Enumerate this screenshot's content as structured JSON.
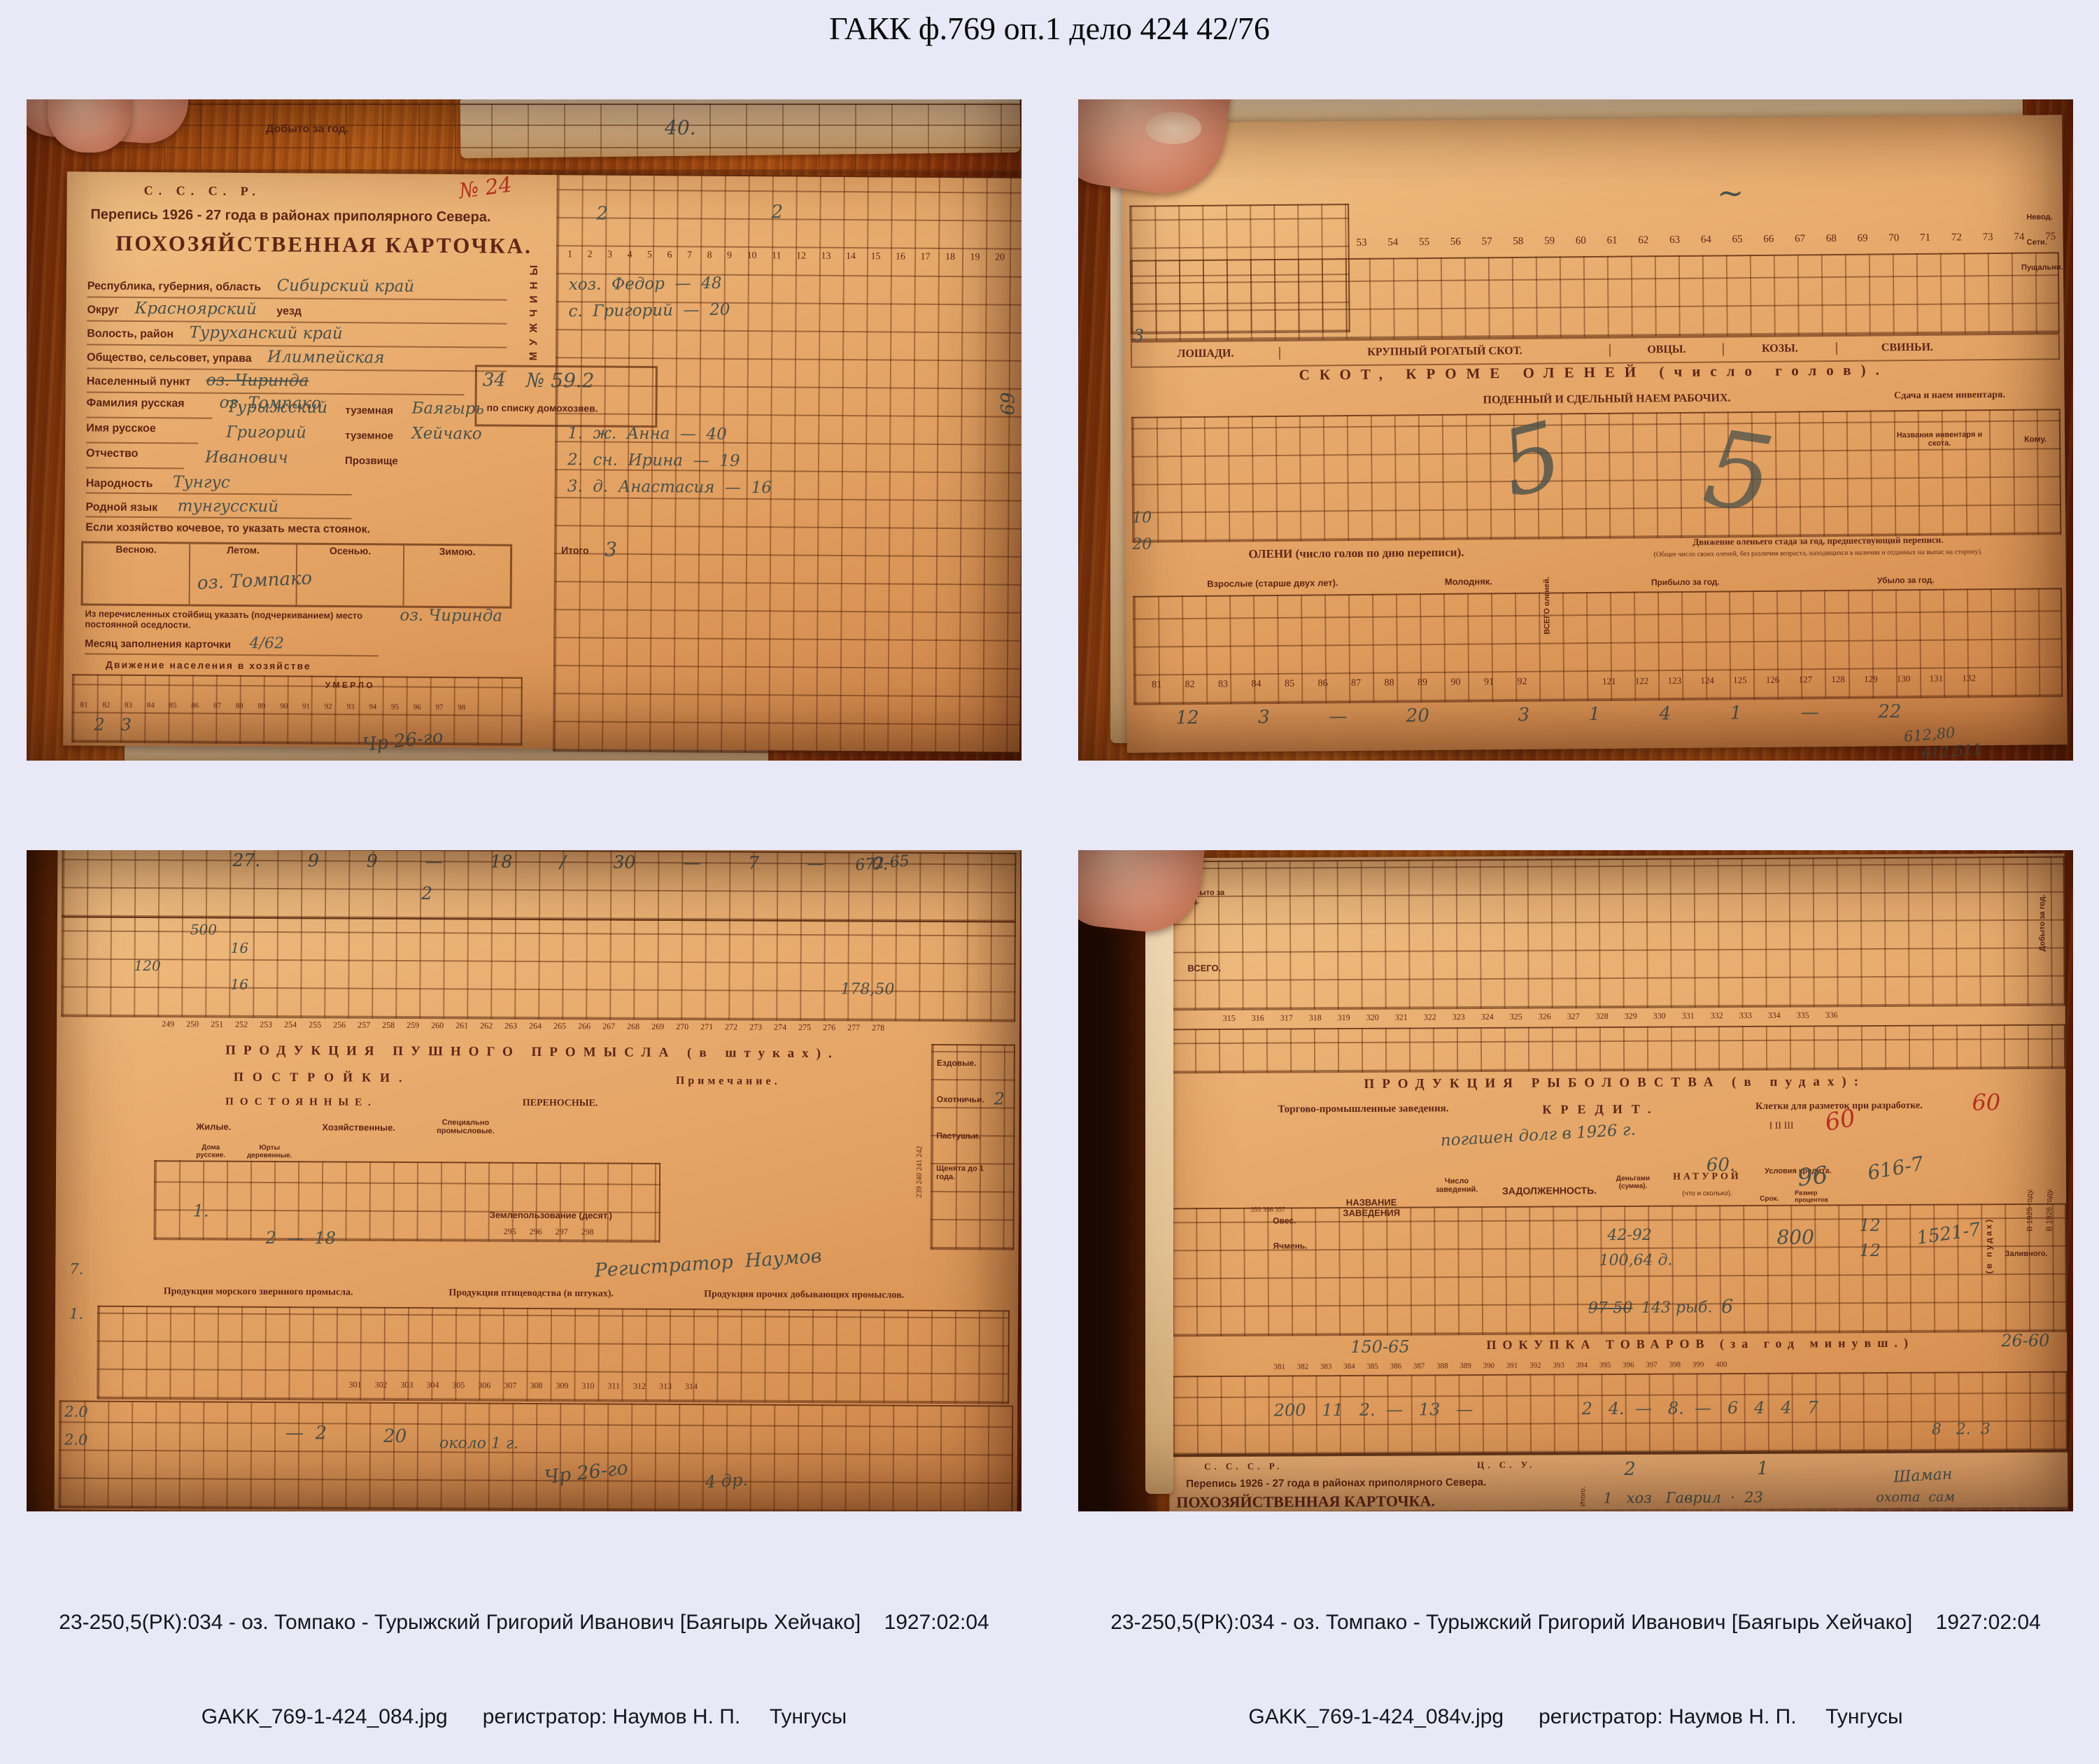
{
  "page": {
    "title": "ГАКК ф.769 оп.1 дело 424 42/76"
  },
  "colors": {
    "background": "#e8e8f6",
    "wood": "#a84e12",
    "paper": "#e3a263",
    "ink": "#5e2614",
    "pencil": "#49514a",
    "red_ink": "#b5311f"
  },
  "photos": [
    {
      "caption1": "23-250,5(РК):034 - оз. Томпако - Турыжский Григорий Иванович [Баягырь Хейчако]    1927:02:04",
      "caption2": "GAKK_769-1-424_083.jpg      регистратор: Наумов Н. П.     Тунгусы",
      "overlay": {
        "top_strip_label": "Добыто за год.",
        "top_strip_hand": "40.",
        "red_note": "№ 24",
        "cccp": "С. С. С. Р.",
        "census": "Перепись 1926 - 27 года в районах приполярного Севера.",
        "card_title": "ПОХОЗЯЙСТВЕННАЯ КАРТОЧКА.",
        "f1_label": "Республика, губерния, область",
        "f1_value": "Сибирский край",
        "f2_label": "Округ",
        "f2_value": "Красноярский",
        "f2_suffix": "уезд",
        "f3_label": "Волость, район",
        "f3_value": "Туруханский край",
        "f4_label": "Общество, сельсовет, управа",
        "f4_value": "Илимпейская",
        "f5_label": "Населенный пункт",
        "f5_value": "оз. Чиринда",
        "f5_value2": "оз. Томпако",
        "box_no": "34",
        "box_no2": "№ 59.2",
        "box_note": "по списку домохозяев.",
        "f6_label": "Фамилия русская",
        "f6_value": "Турыжский",
        "f6_suffix": "туземная",
        "f6_value2": "Баягырь",
        "f7_label": "Имя русское",
        "f7_value": "Григорий",
        "f7_suffix": "туземное",
        "f7_value2": "Хейчако",
        "f8_label": "Отчество",
        "f8_value": "Иванович",
        "f8_suffix": "Прозвище",
        "f9_label": "Народность",
        "f9_value": "Тунгус",
        "f10_label": "Родной язык",
        "f10_value": "тунгусский",
        "nomad_label": "Если хозяйство кочевое, то указать места стоянок.",
        "season1": "Весною.",
        "season2": "Летом.",
        "season3": "Осенью.",
        "season4": "Зимою.",
        "season_value": "оз. Томпако",
        "settle_label": "Из перечисленных стойбищ указать (подчеркиванием) место постоянной оседлости.",
        "settle_value": "оз. Чиринда",
        "fill_label": "Месяц заполнения карточки",
        "fill_value": "4/62",
        "movement_title": "Движение населения в хозяйстве",
        "movement_sub": "У М Е Р Л О",
        "movement_nums": "81 82 83 84 85 86 87 88 89 90 91 92 93 94 95 96 97 98",
        "movement_hand": "2   3",
        "men_vertical": "МУЖЧИНЫ",
        "cols": "1 2 3 4 5 6 7 8 9 10 11 12 13 14 15 16 17 18 19 20",
        "hand_top1": "2",
        "hand_top2": "2",
        "member1": "хоз.  Федор  —  48",
        "member2": "с.  Григорий  —  20",
        "member3": "1.  ж.  Анна  —  40",
        "member4": "2.  сн.  Ирина  —  19",
        "member5": "3.  д.  Анастасия  —  16",
        "itogo_label": "Итого",
        "itogo_hand": "3",
        "scribble1": "Чр 26-го",
        "scribble2": "69"
      }
    },
    {
      "caption1": "23-250,5(РК):034 - оз. Томпако - Турыжский Григорий Иванович [Баягырь Хейчако]    1927:02:04",
      "caption2": "GAKK_769-1-424_083v.jpg      регистратор: Наумов Н. П.     Тунгусы",
      "overlay": {
        "cols_top": "53 54 55 56 57 58 59 60 61 62 63 64 65 66 67 68 69 70 71 72 73 74 75 76",
        "band_horses": "ЛОШАДИ.",
        "band_cattle": "КРУПНЫЙ РОГАТЫЙ СКОТ.",
        "band_sheep": "ОВЦЫ.",
        "band_goats": "КОЗЫ.",
        "band_pigs": "СВИНЬИ.",
        "band_livestock": "СКОТ,  КРОМЕ  ОЛЕНЕЙ  (число голов).",
        "band_hire": "ПОДЕННЫЙ И СДЕЛЬНЫЙ НАЕМ РАБОЧИХ.",
        "band_rent": "Сдача и наем инвентаря.",
        "inv_label": "Названия инвентаря и скота.",
        "komu_label": "Кому.",
        "band_deer": "ОЛЕНИ  (число голов по дню переписи).",
        "deer_adult": "Взрослые (старше двух лет).",
        "deer_young": "Молодняк.",
        "deer_total": "ВСЕГО оленей.",
        "herd_title": "Движение оленьего стада за год, предшествующий переписи.",
        "herd_sub": "(Общее число своих оленей, без различия возраста, находящихся в наличии и отданных на выпас на сторону).",
        "herd_in": "Прибыло за год.",
        "herd_out": "Убыло за год.",
        "cols_deer": "81 82 83 84 85 86 87 88 89 90 91 92",
        "cols_herd": "121 122 123 124 125 126 127 128 129 130 131 132",
        "hand_big1": "5",
        "hand_big2": "5",
        "hand_margin1": "3",
        "hand_margin2": "10",
        "hand_margin3": "20",
        "hand_row": "12  3  —  20   3  1  4  1  —  22",
        "right_label1": "Невод.",
        "right_label2": "Сети.",
        "right_label3": "Пущальни.",
        "hand_br1": "612,80",
        "hand_br2": "612,511"
      }
    },
    {
      "caption1": "23-250,5(РК):034 - оз. Томпако - Турыжский Григорий Иванович [Баягырь Хейчако]    1927:02:04",
      "caption2": "GAKK_769-1-424_084.jpg      регистратор: Наумов Н. П.     Тунгусы",
      "overlay": {
        "hand_top_row": "27.  9  9  —  18  /  30  —  7  —  0.",
        "hand_top2": "2",
        "margin_hand1": "500",
        "margin_hand2": "16",
        "margin_hand3": "120",
        "margin_hand4": "16",
        "hand_tr1": "672-65",
        "hand_tr2": "178,50",
        "cols_top": "249 250 251 252 253 254 255 256 257 258 259 260 261 262 263 264 265 266 267 268 269 270 271 272 273 274 275 276 277 278",
        "band_fur": "ПРОДУКЦИЯ  ПУШНОГО  ПРОМЫСЛА  (в штуках).",
        "band_build": "ПОСТРОЙКИ.",
        "band_note": "Примечание.",
        "band_perm": "ПОСТОЯННЫЕ.",
        "band_port": "ПЕРЕНОСНЫЕ.",
        "h_dwell": "Жилые.",
        "h_house": "Хозяйственные.",
        "h_spec": "Специально промысловые.",
        "h_homes": "Дома русские.",
        "h_yurts": "Юрты деревянные.",
        "dogs1": "Ездовые.",
        "dogs2": "Охотничьи.",
        "dogs3": "Пастушьи.",
        "dogs4": "Щенята до 1 года.",
        "dogs_nums": "239 240 241 242",
        "dogs_hand": "2",
        "land_label": "Землепользование (десят.)",
        "land_nums": "295 296 297 298",
        "hand_mid1": "1.",
        "hand_mid2": "2  —  18",
        "sign_hand": "Регистратор  Наумов",
        "band_sea": "Продукция морского звериного промысла.",
        "band_birds": "Продукция птицеводства (в штуках).",
        "band_other": "Продукция прочих добывающих промыслов.",
        "cols_low": "301 302 303 304 305 306 307 308 309 310 311 312 313 314",
        "hand_low1": "—  2",
        "hand_low2": "20",
        "hand_low3": "около 1 г.",
        "scrib1": "Чр 26-го",
        "scrib2": "4 др.",
        "margin_low1": "7.",
        "margin_low2": "1.",
        "margin_low3": "2.0",
        "margin_low4": "2.0"
      }
    },
    {
      "caption1": "23-250,5(РК):034 - оз. Томпако - Турыжский Григорий Иванович [Баягырь Хейчако]    1927:02:04",
      "caption2": "GAKK_769-1-424_084v.jpg      регистратор: Наумов Н. П.     Тунгусы",
      "overlay": {
        "corner_label": "Добыто за год.",
        "vsego_label": "ВСЕГО.",
        "cols_top": "315 316 317 318 319 320 321 322 323 324 325 326 327 328 329 330 331 332 333 334 335 336",
        "band_fish": "ПРОДУКЦИЯ  РЫБОЛОВСТВА  (в пудах):",
        "trade_label": "Торгово-промышленные заведения.",
        "credit_label": "КРЕДИТ.",
        "credit_hand": "погашен долг в 1926 г.",
        "cells_label": "Клетки для разметок при разработке.",
        "cells_cols": "I      II      III",
        "red1": "60",
        "red2": "60",
        "debt_label": "ЗАДОЛЖЕННОСТЬ.",
        "money_label": "Деньгами (сумма).",
        "natural_label": "НАТУРОЙ",
        "natural_sub": "(что и сколько).",
        "terms_label": "Условия кредита.",
        "term1": "Срок.",
        "term2": "Размер процентов",
        "name_label": "НАЗВАНИЕ ЗАВЕДЕНИЯ",
        "count_label": "Число заведений.",
        "grain1": "Овес.",
        "grain2": "Ячмень.",
        "grain_nums": "355 356 357",
        "hand_60": "60.",
        "hand_96": "96",
        "hand_616": "616-7",
        "hand_800": "800",
        "hand_12a": "12",
        "hand_12b": "12",
        "hand_1521": "1521-7",
        "hand_4292": "42-92",
        "hand_100": "100,64 д.",
        "hand_9750": "97-50",
        "hand_fish": "143 рыб.",
        "hand_6": "6",
        "vpudah": "(в пудах)",
        "zaliv": "Заливного.",
        "y1925": "В 1925 году.",
        "y1926": "В 1926 году.",
        "band_buy_pre": "150-65",
        "band_buy": "ПОКУПКА  ТОВАРОВ  (за год минувш.)",
        "band_buy_post": "26-60",
        "cols_buy": "381 382 383 384 385 386 387 388 389 390 391 392 393 394 395 396 397 398 399 400",
        "hand_rowA": "200   11   2.  —   13   —",
        "hand_rowB": "2   4.  —   8.  —   6   4   4   7",
        "hand_rowC": "8   2.  3",
        "next_cccp": "С. С. С. Р.",
        "next_csu": "Ц. С. У.",
        "next_census": "Перепись 1926 - 27 года в районах приполярного Севера.",
        "next_title": "ПОХОЗЯЙСТВЕННАЯ КАРТОЧКА.",
        "itogo_label": "Итого.",
        "itogo_hand1": "2",
        "itogo_hand2": "1",
        "next_row_hand": "1   хоз   Гаврил  ·  23",
        "shaman_hand": "Шаман",
        "ohota_hand": "охота  сам"
      }
    }
  ]
}
